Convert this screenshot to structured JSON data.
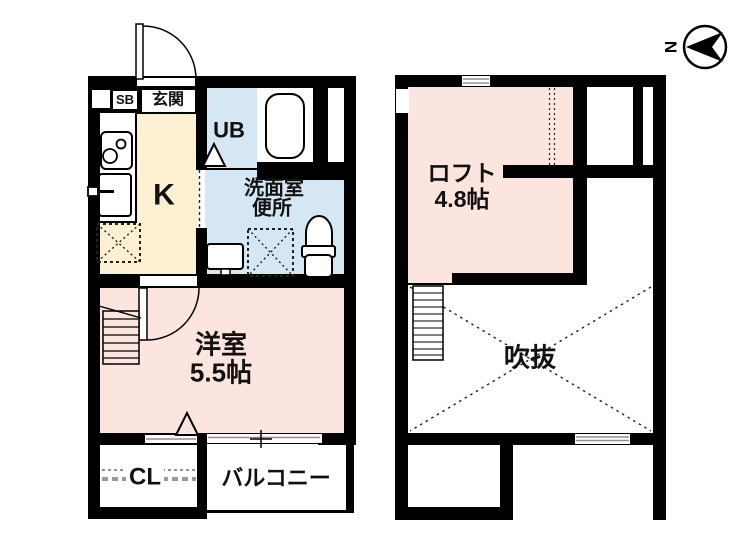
{
  "floor1": {
    "entrance_label": "玄関",
    "shoe_box_label": "SB",
    "kitchen_label": "K",
    "unit_bath_label": "UB",
    "washroom_line1": "洗面室",
    "washroom_line2": "便所",
    "western_room_name": "洋室",
    "western_room_size": "5.5帖",
    "closet_label": "CL",
    "balcony_label": "バルコニー"
  },
  "floor2": {
    "loft_name": "ロフト",
    "loft_size": "4.8帖",
    "void_label": "吹抜"
  },
  "compass": {
    "north_label": "N"
  },
  "colors": {
    "wall": "#000000",
    "room_pink": "#FBE5DE",
    "wet_blue": "#D5E7F2",
    "kitchen_cream": "#FCEFD2",
    "gray_line": "#909090"
  }
}
